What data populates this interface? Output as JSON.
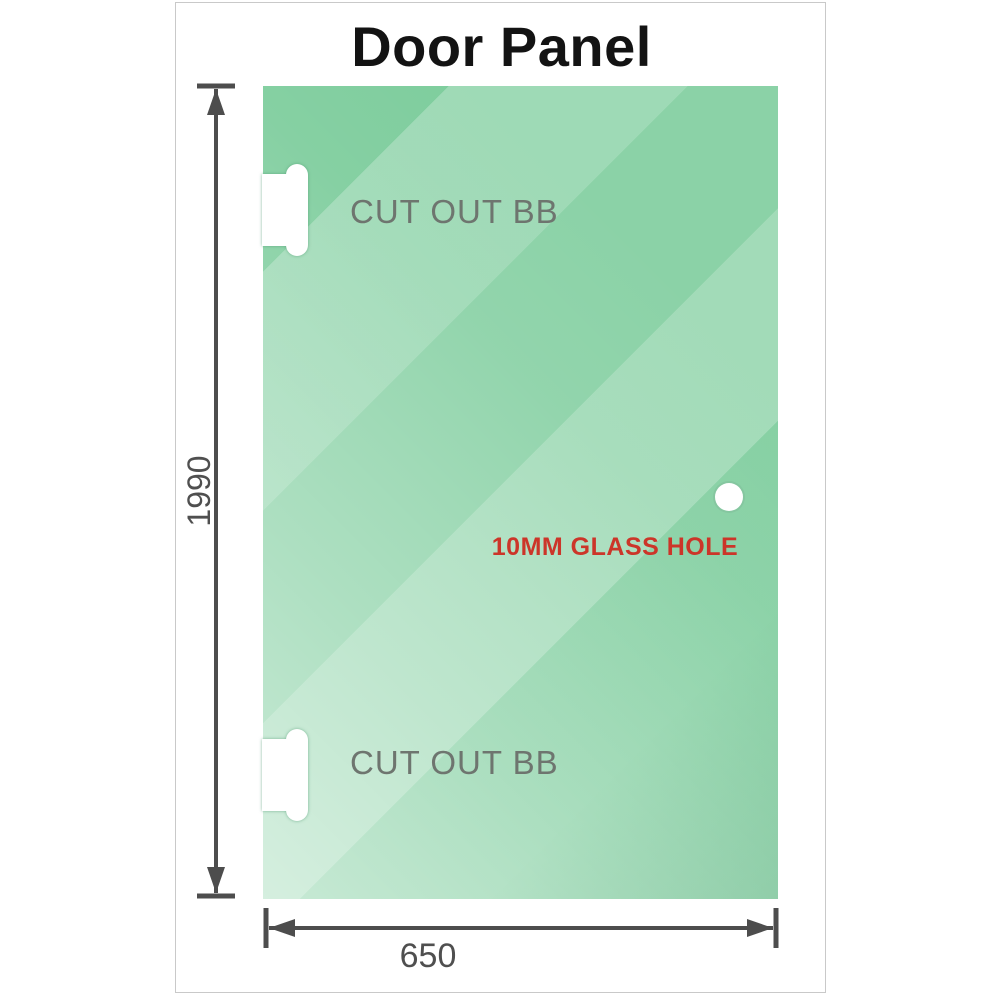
{
  "title": "Door Panel",
  "panel": {
    "type": "glass-door-panel",
    "glass_base_color": "#7ecd9d",
    "cutouts": [
      {
        "label": "CUT OUT BB",
        "position": "top-left-edge"
      },
      {
        "label": "CUT OUT BB",
        "position": "bottom-left-edge"
      }
    ],
    "hole": {
      "label": "10MM GLASS HOLE",
      "label_color": "#cc3529",
      "position": "middle-right"
    }
  },
  "dimensions": {
    "height": {
      "value": "1990",
      "orientation": "vertical"
    },
    "width": {
      "value": "650",
      "orientation": "horizontal"
    }
  },
  "colors": {
    "dimension_lines": "#4d4d4d",
    "cutout_label": "#6e756f",
    "title": "#131313",
    "frame_border": "#c9c9c9"
  }
}
